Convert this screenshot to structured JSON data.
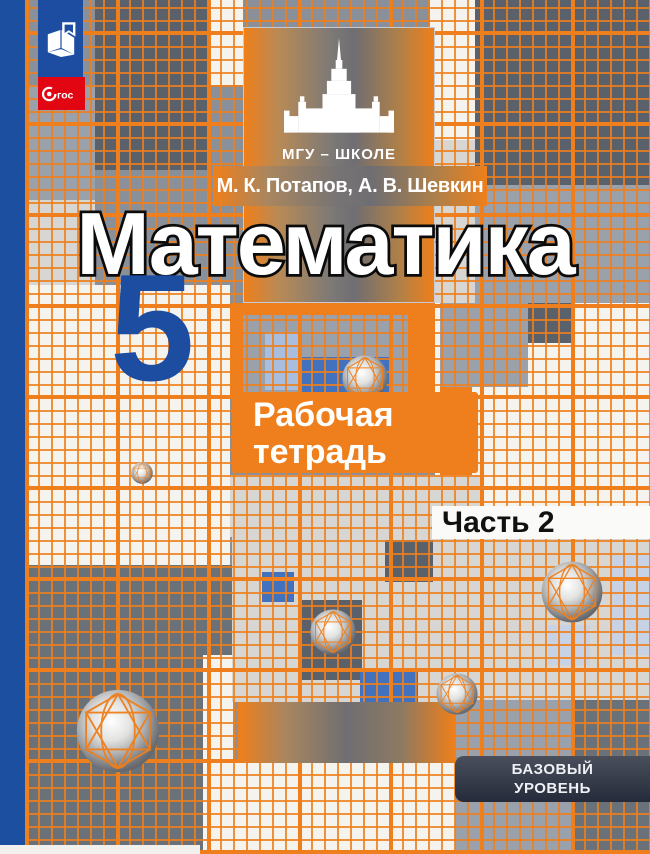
{
  "cover": {
    "series": "МГУ – ШКОЛЕ",
    "authors": "М. К. Потапов,  А. В. Шевкин",
    "title": "Математика",
    "grade": "5",
    "workbook_line1": "Рабочая",
    "workbook_line2": "тетрадь",
    "part": "Часть 2",
    "level_line1": "БАЗОВЫЙ",
    "level_line2": "УРОВЕНЬ",
    "fgos_text": "гос"
  },
  "colors": {
    "accent_orange": "#ee7f1c",
    "brand_blue": "#1c4da1",
    "fgos_red": "#e20613",
    "badge_navy": "#2c3140",
    "grid_blue_cell": "#4272bd"
  }
}
